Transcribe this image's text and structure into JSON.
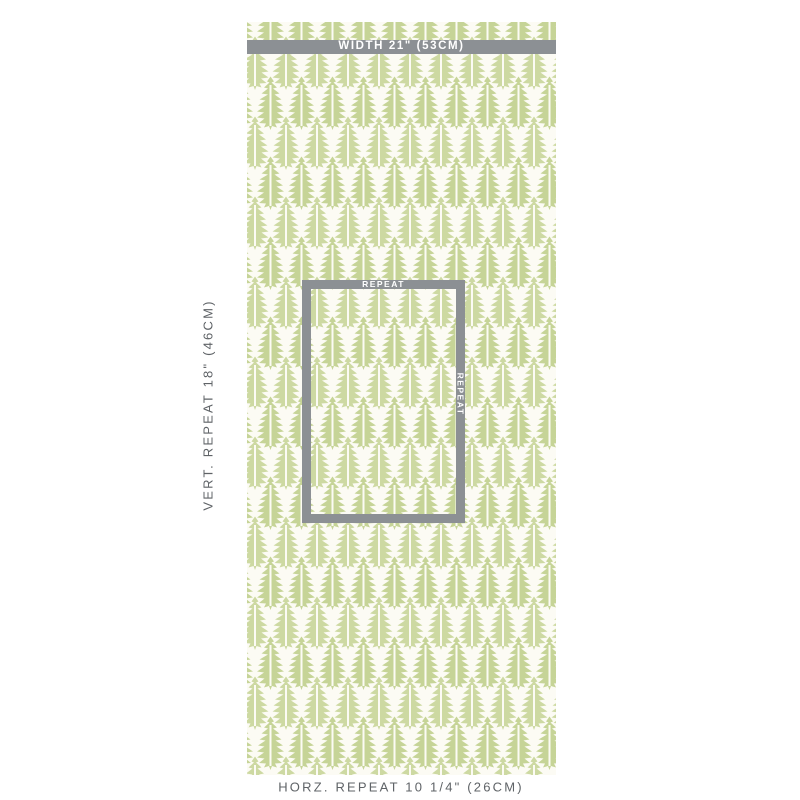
{
  "diagram": {
    "width_bar_label": "WIDTH 21\" (53CM)",
    "vert_repeat_label": "VERT. REPEAT 18\" (46CM)",
    "horz_repeat_label": "HORZ. REPEAT 10 1/4\" (26CM)",
    "repeat_box": {
      "top_label": "REPEAT",
      "side_label": "REPEAT"
    },
    "pattern": {
      "motif": "leaf-block-print",
      "colors": {
        "leaf_green": "#c6d497",
        "leaf_green_alt": "#cdd9a2",
        "swatch_background": "#fcfbf4",
        "measure_gray": "#8c9094",
        "label_gray": "#5f6367",
        "page_background": "#ffffff"
      }
    }
  }
}
